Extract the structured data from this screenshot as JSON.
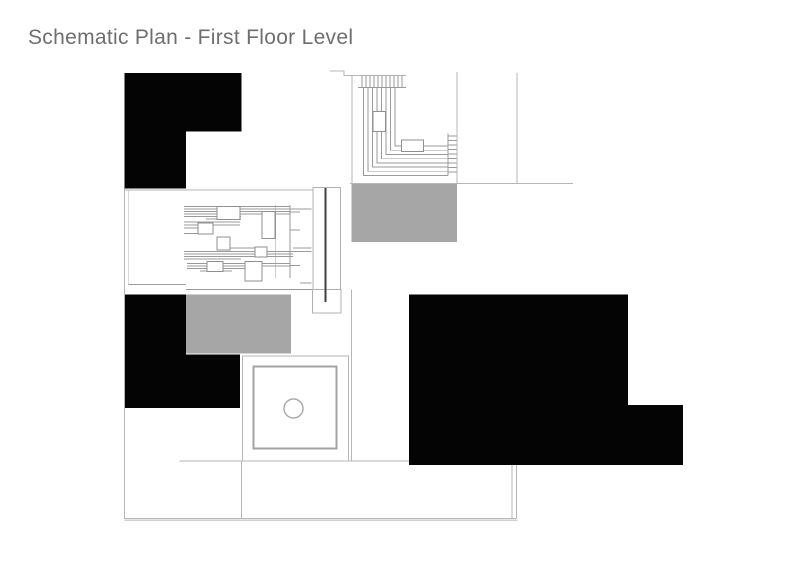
{
  "page": {
    "title": "Schematic Plan - First Floor Level"
  },
  "colors": {
    "background": "#ffffff",
    "mass_black": "#040404",
    "zone_gray": "#a6a6a6",
    "line_light": "#b6b6b6",
    "line_medium": "#9a9a9a",
    "line_dark": "#3f3f3f",
    "title_text": "#6e6e6e"
  },
  "plan": {
    "regions": [
      {
        "name": "wall-mass-top-left",
        "type": "solid-poche"
      },
      {
        "name": "wall-mass-bottom-left",
        "type": "solid-poche"
      },
      {
        "name": "wall-mass-right",
        "type": "solid-poche"
      },
      {
        "name": "gray-zone-upper",
        "type": "shaded-zone"
      },
      {
        "name": "gray-zone-lower",
        "type": "shaded-zone"
      },
      {
        "name": "stair-detail",
        "type": "linework"
      },
      {
        "name": "millwork-detail",
        "type": "linework"
      },
      {
        "name": "wall-core",
        "type": "linework"
      },
      {
        "name": "table-fixture-with-circle",
        "type": "fixture"
      },
      {
        "name": "plan-boundary",
        "type": "outline"
      }
    ]
  }
}
